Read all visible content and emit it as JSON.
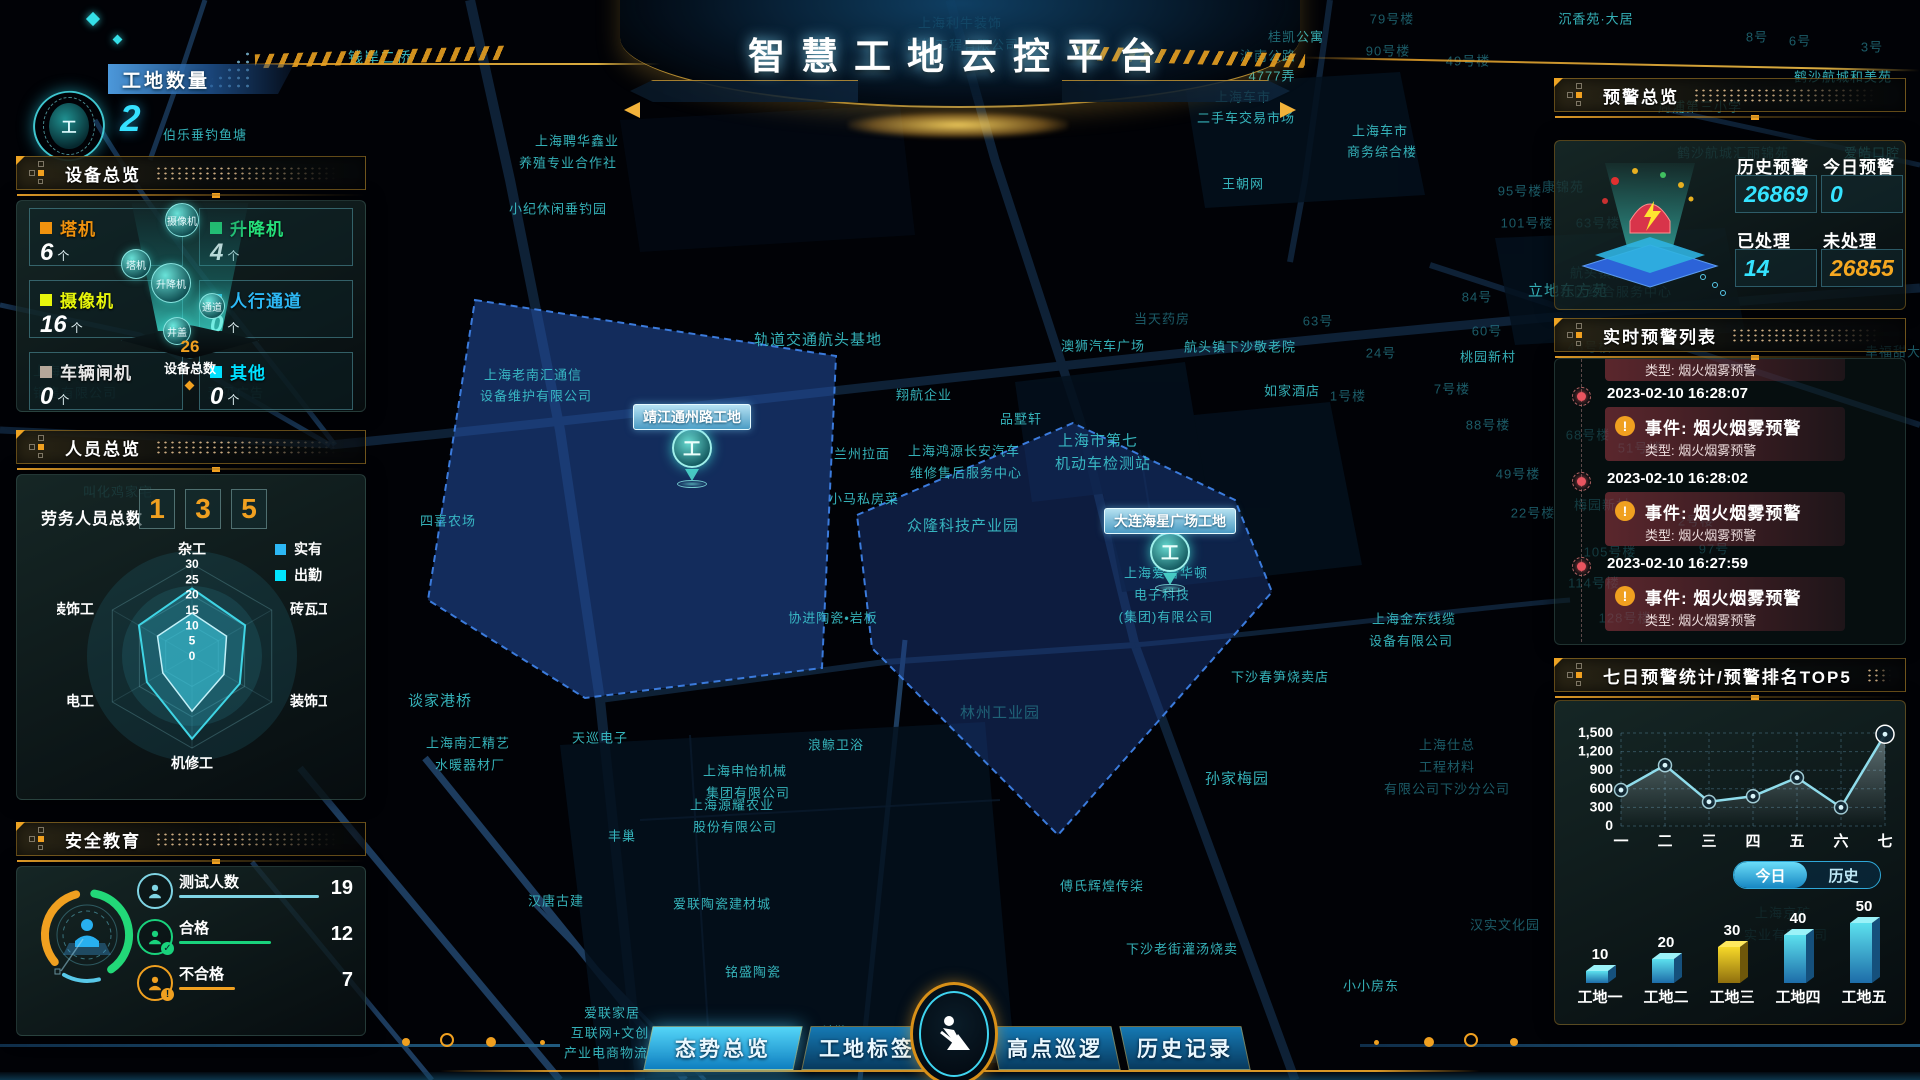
{
  "header": {
    "title": "智慧工地云控平台"
  },
  "site_count": {
    "label": "工地数量",
    "value": "2"
  },
  "device_panel": {
    "title": "设备总览",
    "items": [
      {
        "label": "塔机",
        "count": "6",
        "unit": "个",
        "color": "#f0920e"
      },
      {
        "label": "升降机",
        "count": "4",
        "unit": "个",
        "color": "#25e07a"
      },
      {
        "label": "摄像机",
        "count": "16",
        "unit": "个",
        "color": "#e6f50c"
      },
      {
        "label": "人行通道",
        "count": "0",
        "unit": "个",
        "color": "#2db8f5"
      },
      {
        "label": "车辆闸机",
        "count": "0",
        "unit": "个",
        "color": "#b5a79a",
        "label_color": "#e8e8e8"
      },
      {
        "label": "其他",
        "count": "0",
        "unit": "个",
        "color": "#00e0ff"
      }
    ],
    "bubbles": [
      "摄像机",
      "塔机",
      "升降机",
      "通道",
      "井盖"
    ],
    "total_value": "26",
    "total_label": "设备总数"
  },
  "personnel_panel": {
    "title": "人员总览",
    "total_label": "劳务人员总数",
    "digits": [
      "1",
      "3",
      "5"
    ],
    "legend": [
      {
        "label": "实有",
        "color": "#2db8f5"
      },
      {
        "label": "出勤",
        "color": "#00e5ff"
      }
    ],
    "radar": {
      "type": "radar",
      "axes": [
        "杂工",
        "砖瓦工",
        "装饰工",
        "机修工",
        "电工",
        "装饰工"
      ],
      "scale_ticks": [
        "30",
        "25",
        "20",
        "15",
        "10",
        "5",
        "0"
      ],
      "max": 30,
      "series": [
        {
          "name": "实有",
          "values": [
            22,
            20,
            18,
            27,
            17,
            20
          ]
        },
        {
          "name": "出勤",
          "values": [
            14,
            13,
            12,
            18,
            11,
            13
          ]
        }
      ]
    }
  },
  "safety_panel": {
    "title": "安全教育",
    "rows": [
      {
        "label": "测试人数",
        "value": "19",
        "color": "#7fd4e4",
        "badge": "",
        "line_w": 140
      },
      {
        "label": "合格",
        "value": "12",
        "color": "#19d27c",
        "badge": "✓",
        "line_w": 92
      },
      {
        "label": "不合格",
        "value": "7",
        "color": "#f0a020",
        "badge": "!",
        "line_w": 56
      }
    ]
  },
  "alert_overview": {
    "title": "预警总览",
    "stats": [
      {
        "label": "历史预警",
        "value": "26869",
        "color": "#35e3ff"
      },
      {
        "label": "今日预警",
        "value": "0",
        "color": "#35e3ff"
      },
      {
        "label": "已处理",
        "value": "14",
        "color": "#35e3ff"
      },
      {
        "label": "未处理",
        "value": "26855",
        "color": "#f6a820"
      }
    ]
  },
  "alert_list": {
    "title": "实时预警列表",
    "partial_top": "类型: 烟火烟雾预警",
    "items": [
      {
        "time": "2023-02-10 16:28:07",
        "event": "事件: 烟火烟雾预警",
        "type": "类型: 烟火烟雾预警"
      },
      {
        "time": "2023-02-10 16:28:02",
        "event": "事件: 烟火烟雾预警",
        "type": "类型: 烟火烟雾预警"
      },
      {
        "time": "2023-02-10 16:27:59",
        "event": "事件: 烟火烟雾预警",
        "type": "类型: 烟火烟雾预警"
      }
    ]
  },
  "weekly_panel": {
    "title": "七日预警统计/预警排名TOP5",
    "line_chart": {
      "type": "line",
      "x": [
        "一",
        "二",
        "三",
        "四",
        "五",
        "六",
        "七"
      ],
      "values": [
        580,
        980,
        390,
        480,
        780,
        300,
        1480
      ],
      "y_ticks": [
        "1,500",
        "1,200",
        "900",
        "600",
        "300",
        "0"
      ],
      "ylim": [
        0,
        1500
      ],
      "line_color": "#8fdceb",
      "grid": true
    },
    "toggle": {
      "options": [
        {
          "label": "今日",
          "active": true
        },
        {
          "label": "历史",
          "active": false
        }
      ]
    },
    "bar_chart": {
      "type": "bar",
      "categories": [
        "工地一",
        "工地二",
        "工地三",
        "工地四",
        "工地五"
      ],
      "values": [
        10,
        20,
        30,
        40,
        50
      ],
      "colors": [
        "cyan",
        "cyan",
        "yellow",
        "cyan",
        "cyan"
      ]
    }
  },
  "bottom_tabs": [
    {
      "label": "态势总览",
      "active": true
    },
    {
      "label": "工地标签",
      "active": false
    },
    {
      "label": "高点巡逻",
      "active": false
    },
    {
      "label": "历史记录",
      "active": false
    }
  ],
  "map": {
    "site_markers": [
      {
        "label": "靖江通州路工地",
        "x": 692,
        "y": 468,
        "glyph": "工"
      },
      {
        "label": "大连海星广场工地",
        "x": 1170,
        "y": 572,
        "glyph": "工"
      }
    ],
    "labels": [
      {
        "t": "上海利牛装饰",
        "x": 960,
        "y": 22
      },
      {
        "t": "装修工程有限公司",
        "x": 963,
        "y": 44
      },
      {
        "t": "钱岸二桥",
        "x": 380,
        "y": 57,
        "s": 15
      },
      {
        "t": "桂凯公寓",
        "x": 1296,
        "y": 36
      },
      {
        "t": "沪南公路",
        "x": 1268,
        "y": 55
      },
      {
        "t": "4777弄",
        "x": 1272,
        "y": 75
      },
      {
        "t": "79号楼",
        "x": 1392,
        "y": 18,
        "dim": true
      },
      {
        "t": "90号楼",
        "x": 1388,
        "y": 50,
        "dim": true
      },
      {
        "t": "49号楼",
        "x": 1468,
        "y": 60,
        "dim": true
      },
      {
        "t": "沉香苑·大居",
        "x": 1596,
        "y": 18
      },
      {
        "t": "8号",
        "x": 1757,
        "y": 36,
        "dim": true
      },
      {
        "t": "6号",
        "x": 1800,
        "y": 40,
        "dim": true
      },
      {
        "t": "3号",
        "x": 1872,
        "y": 46,
        "dim": true
      },
      {
        "t": "鹤沙航城和美苑",
        "x": 1843,
        "y": 76
      },
      {
        "t": "周浦第三小学",
        "x": 1700,
        "y": 106
      },
      {
        "t": "鹤沙航城汇丽锦苑",
        "x": 1733,
        "y": 152,
        "dim": true
      },
      {
        "t": "爱皓口腔",
        "x": 1872,
        "y": 152
      },
      {
        "t": "上海车市",
        "x": 1243,
        "y": 96
      },
      {
        "t": "二手车交易市场",
        "x": 1246,
        "y": 117
      },
      {
        "t": "上海车市",
        "x": 1380,
        "y": 130
      },
      {
        "t": "商务综合楼",
        "x": 1382,
        "y": 151
      },
      {
        "t": "王朝网",
        "x": 1243,
        "y": 183
      },
      {
        "t": "上海聘华鑫业",
        "x": 577,
        "y": 140
      },
      {
        "t": "养殖专业合作社",
        "x": 568,
        "y": 162
      },
      {
        "t": "伯乐垂钓鱼塘",
        "x": 205,
        "y": 134
      },
      {
        "t": "小纪休闲垂钓园",
        "x": 558,
        "y": 208
      },
      {
        "t": "康锦苑",
        "x": 1563,
        "y": 186,
        "dim": true
      },
      {
        "t": "95号楼",
        "x": 1520,
        "y": 190,
        "dim": true
      },
      {
        "t": "63号楼",
        "x": 1598,
        "y": 222,
        "dim": true
      },
      {
        "t": "101号楼",
        "x": 1527,
        "y": 222,
        "dim": true
      },
      {
        "t": "上海老南汇通信",
        "x": 533,
        "y": 374
      },
      {
        "t": "设备维护有限公司",
        "x": 536,
        "y": 395
      },
      {
        "t": "轨道交通航头基地",
        "x": 818,
        "y": 339,
        "s": 15
      },
      {
        "t": "当天药房",
        "x": 1162,
        "y": 318,
        "dim": true
      },
      {
        "t": "澳狮汽车广场",
        "x": 1103,
        "y": 345
      },
      {
        "t": "航头镇下沙敬老院",
        "x": 1240,
        "y": 346
      },
      {
        "t": "翔航企业",
        "x": 924,
        "y": 394
      },
      {
        "t": "品墅轩",
        "x": 1021,
        "y": 418
      },
      {
        "t": "兰州拉面",
        "x": 862,
        "y": 453
      },
      {
        "t": "上海鸿源长安汽车",
        "x": 964,
        "y": 450
      },
      {
        "t": "维修售后服务中心",
        "x": 966,
        "y": 472
      },
      {
        "t": "小马私房菜",
        "x": 864,
        "y": 498
      },
      {
        "t": "上海市第七",
        "x": 1098,
        "y": 440,
        "s": 15
      },
      {
        "t": "机动车检测站",
        "x": 1103,
        "y": 463,
        "s": 15
      },
      {
        "t": "如家酒店",
        "x": 1292,
        "y": 390
      },
      {
        "t": "1号楼",
        "x": 1348,
        "y": 395,
        "dim": true
      },
      {
        "t": "7号楼",
        "x": 1452,
        "y": 388,
        "dim": true
      },
      {
        "t": "88号楼",
        "x": 1488,
        "y": 424,
        "dim": true
      },
      {
        "t": "49号楼",
        "x": 1518,
        "y": 473,
        "dim": true
      },
      {
        "t": "22号楼",
        "x": 1533,
        "y": 512,
        "dim": true
      },
      {
        "t": "84号",
        "x": 1477,
        "y": 296,
        "dim": true
      },
      {
        "t": "63号",
        "x": 1318,
        "y": 320,
        "dim": true
      },
      {
        "t": "60号",
        "x": 1487,
        "y": 330,
        "dim": true
      },
      {
        "t": "24号",
        "x": 1381,
        "y": 352,
        "dim": true
      },
      {
        "t": "桃园新村",
        "x": 1488,
        "y": 356
      },
      {
        "t": "立地东方苑",
        "x": 1568,
        "y": 290,
        "s": 15
      },
      {
        "t": "航头镇沉香村",
        "x": 1612,
        "y": 272,
        "dim": true
      },
      {
        "t": "社区综合服务中心",
        "x": 1616,
        "y": 291,
        "dim": true
      },
      {
        "t": "众隆科技产业园",
        "x": 963,
        "y": 525,
        "s": 15
      },
      {
        "t": "协进陶瓷•岩板",
        "x": 833,
        "y": 617
      },
      {
        "t": "林州工业园",
        "x": 1000,
        "y": 712,
        "s": 15,
        "dim": true
      },
      {
        "t": "四喜农场",
        "x": 448,
        "y": 520
      },
      {
        "t": "谈家港桥",
        "x": 440,
        "y": 700,
        "s": 15
      },
      {
        "t": "上海南汇精艺",
        "x": 468,
        "y": 742
      },
      {
        "t": "水暖器材厂",
        "x": 470,
        "y": 764
      },
      {
        "t": "天巡电子",
        "x": 600,
        "y": 737
      },
      {
        "t": "上海申怡机械",
        "x": 745,
        "y": 770
      },
      {
        "t": "集团有限公司",
        "x": 748,
        "y": 792
      },
      {
        "t": "浪鲸卫浴",
        "x": 836,
        "y": 744
      },
      {
        "t": "丰巢",
        "x": 622,
        "y": 835
      },
      {
        "t": "上海源耀农业",
        "x": 732,
        "y": 804
      },
      {
        "t": "股份有限公司",
        "x": 735,
        "y": 826
      },
      {
        "t": "汉唐古建",
        "x": 556,
        "y": 900
      },
      {
        "t": "爱联陶瓷建材城",
        "x": 722,
        "y": 903
      },
      {
        "t": "铭盛陶瓷",
        "x": 753,
        "y": 971
      },
      {
        "t": "爱联家居",
        "x": 612,
        "y": 1012
      },
      {
        "t": "互联网+文创",
        "x": 610,
        "y": 1032
      },
      {
        "t": "产业电商物流园",
        "x": 613,
        "y": 1052
      },
      {
        "t": "科勒",
        "x": 834,
        "y": 1031
      },
      {
        "t": "傅氏辉煌传柒",
        "x": 1102,
        "y": 885
      },
      {
        "t": "下沙老街灌汤烧卖",
        "x": 1182,
        "y": 948
      },
      {
        "t": "小小房东",
        "x": 1371,
        "y": 985
      },
      {
        "t": "孙家梅园",
        "x": 1237,
        "y": 778,
        "s": 15
      },
      {
        "t": "下沙春笋烧卖店",
        "x": 1280,
        "y": 676
      },
      {
        "t": "上海金东线缆",
        "x": 1414,
        "y": 618
      },
      {
        "t": "设备有限公司",
        "x": 1411,
        "y": 640
      },
      {
        "t": "上海仕总",
        "x": 1447,
        "y": 744,
        "dim": true
      },
      {
        "t": "工程材料",
        "x": 1447,
        "y": 766,
        "dim": true
      },
      {
        "t": "有限公司下沙分公司",
        "x": 1447,
        "y": 788,
        "dim": true
      },
      {
        "t": "汉实文化园",
        "x": 1505,
        "y": 924,
        "dim": true
      },
      {
        "t": "上海京矿",
        "x": 1783,
        "y": 912,
        "dim": true
      },
      {
        "t": "实业有限公司",
        "x": 1786,
        "y": 934,
        "dim": true
      },
      {
        "t": "上海爱普华顿",
        "x": 1166,
        "y": 572
      },
      {
        "t": "电子科技",
        "x": 1162,
        "y": 594
      },
      {
        "t": "(集团)有限公司",
        "x": 1166,
        "y": 616
      },
      {
        "t": "上海恩锡汽车",
        "x": 75,
        "y": 370,
        "dim": true
      },
      {
        "t": "销售有限公司",
        "x": 75,
        "y": 392,
        "dim": true
      },
      {
        "t": "豫见广告",
        "x": 236,
        "y": 392,
        "dim": true
      },
      {
        "t": "叫化鸡家宅",
        "x": 118,
        "y": 491,
        "dim": true
      },
      {
        "t": "48号楼",
        "x": 1590,
        "y": 346,
        "dim": true
      },
      {
        "t": "68号楼",
        "x": 1588,
        "y": 434,
        "dim": true
      },
      {
        "t": "51号楼",
        "x": 1640,
        "y": 447,
        "dim": true
      },
      {
        "t": "梅园新村",
        "x": 1602,
        "y": 504,
        "dim": true
      },
      {
        "t": "2号楼",
        "x": 1696,
        "y": 520,
        "dim": true
      },
      {
        "t": "97号",
        "x": 1714,
        "y": 548,
        "dim": true
      },
      {
        "t": "105号楼",
        "x": 1610,
        "y": 551,
        "dim": true
      },
      {
        "t": "114号楼",
        "x": 1594,
        "y": 582,
        "dim": true
      },
      {
        "t": "128号楼",
        "x": 1625,
        "y": 617,
        "dim": true
      },
      {
        "t": "幸福甜大",
        "x": 1893,
        "y": 351,
        "dim": true
      }
    ]
  }
}
